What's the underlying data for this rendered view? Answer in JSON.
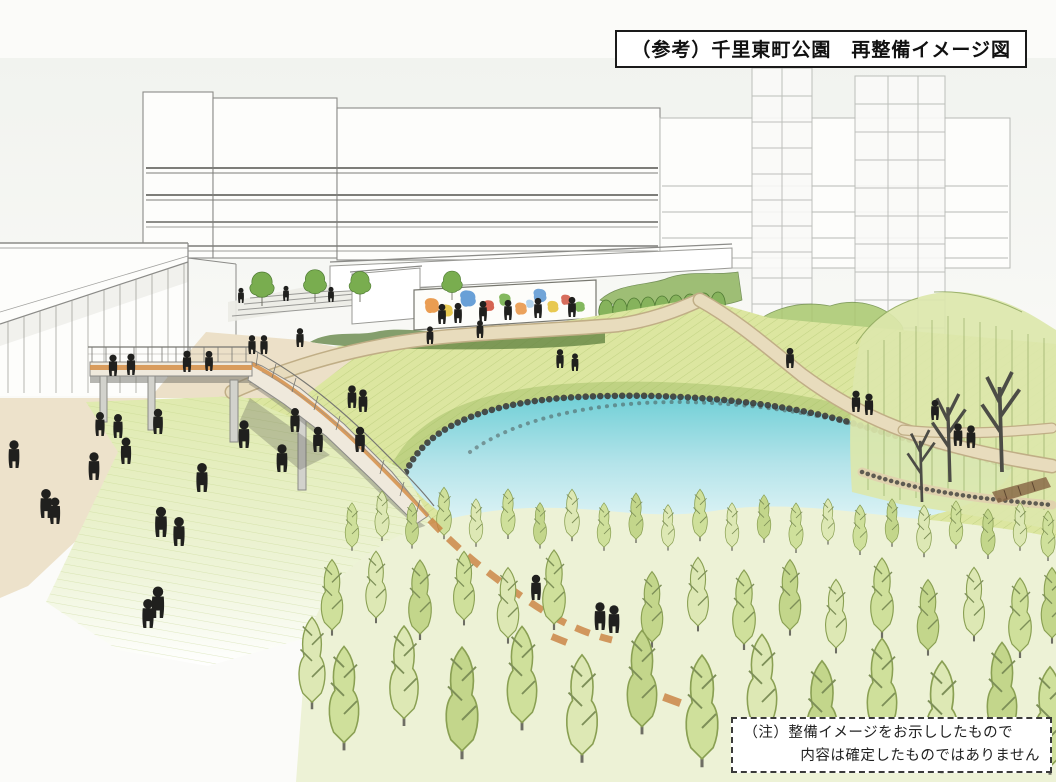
{
  "title_box": {
    "text": "（参考）千里東町公園　再整備イメージ図"
  },
  "note_box": {
    "line1": "（注）整備イメージをお示ししたもので",
    "line2": "内容は確定したものではありません"
  },
  "illustration": {
    "colors": {
      "paper": "#fbfbf9",
      "sky": "#f1f3ef",
      "pencil": "#8b8b88",
      "pencil_faint": "#b7b9b5",
      "grass_base": "#dce6a0",
      "grass_hatch": "#a9c068",
      "lawn_top": "#dfeaae",
      "pond_deep": "#6fcfd6",
      "pond_mid": "#b5e4ea",
      "pond_pale": "#f2fbfb",
      "stone": "#3d3d3b",
      "path_tan": "#e8dcbd",
      "path_edge": "#c0ae86",
      "deck_orange": "#d6934f",
      "boardwalk_orange": "#c9803f",
      "foliage_light": "#cfe09b",
      "foliage_pale": "#dde8b4",
      "foliage_mid": "#a9c86d",
      "foliage_dark": "#5d7f3d",
      "hedge_green": "#86b35c",
      "trunk": "#6e6e64",
      "people": "#20201e",
      "mural_orange": "#e8923f",
      "mural_blue": "#4f8fd0",
      "mural_yellow": "#e6c33e",
      "mural_green": "#76b04c",
      "mural_red": "#d05340",
      "mural_sky": "#9fc8e8"
    }
  }
}
